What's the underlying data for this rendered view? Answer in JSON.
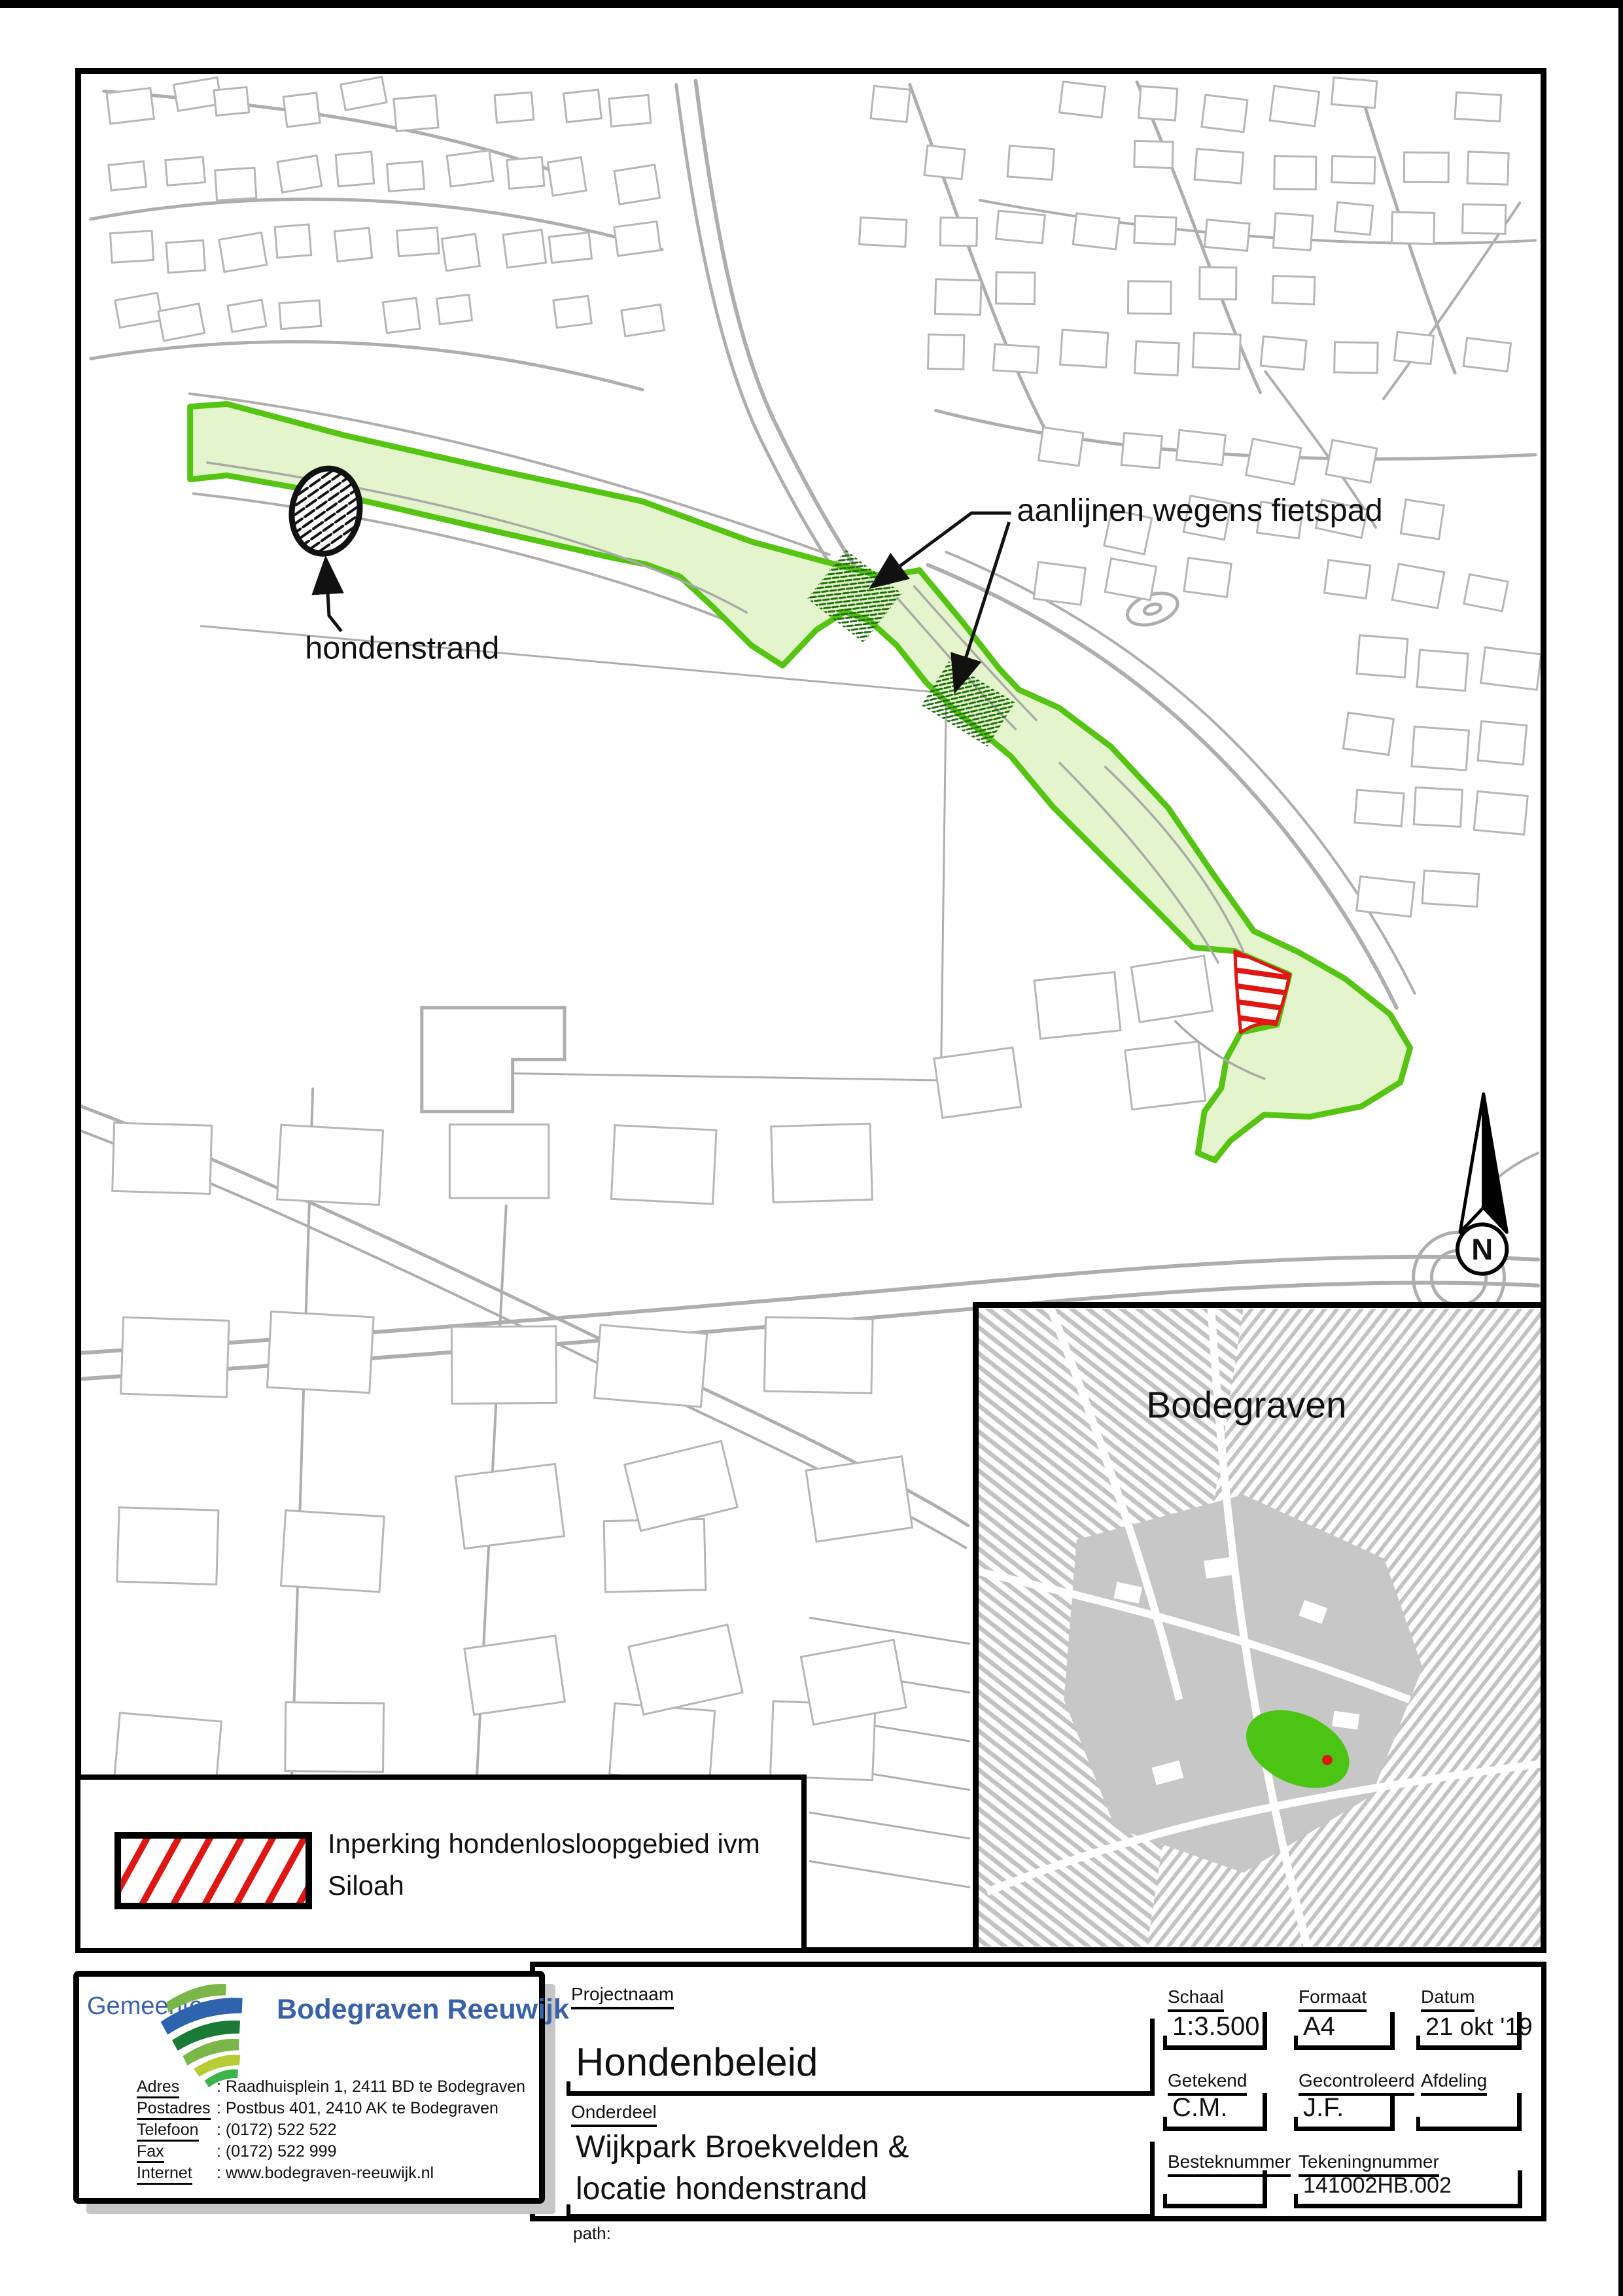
{
  "map": {
    "label_aanlijnen": "aanlijnen wegens fietspad",
    "label_hondenstrand": "hondenstrand",
    "north_label": "N"
  },
  "inset": {
    "title": "Bodegraven"
  },
  "legend": {
    "line1": "Inperking hondenlosloopgebied ivm",
    "line2": "Siloah"
  },
  "logo": {
    "gemeente": "Gemeente",
    "name": "Bodegraven Reeuwijk",
    "rows": [
      {
        "label": "Adres",
        "value": ": Raadhuisplein 1, 2411 BD te Bodegraven"
      },
      {
        "label": "Postadres",
        "value": ": Postbus 401, 2410 AK te Bodegraven"
      },
      {
        "label": "Telefoon",
        "value": ": (0172) 522 522"
      },
      {
        "label": "Fax",
        "value": ": (0172) 522 999"
      },
      {
        "label": "Internet",
        "value": ": www.bodegraven-reeuwijk.nl"
      }
    ]
  },
  "titleblock": {
    "projectnaam_label": "Projectnaam",
    "projectnaam_value": "Hondenbeleid",
    "onderdeel_label": "Onderdeel",
    "onderdeel_value_line1": "Wijkpark Broekvelden &",
    "onderdeel_value_line2": "locatie hondenstrand",
    "schaal_label": "Schaal",
    "schaal_value": "1:3.500",
    "formaat_label": "Formaat",
    "formaat_value": "A4",
    "datum_label": "Datum",
    "datum_value": "21 okt '19",
    "getekend_label": "Getekend",
    "getekend_value": "C.M.",
    "gecontroleerd_label": "Gecontroleerd",
    "gecontroleerd_value": "J.F.",
    "afdeling_label": "Afdeling",
    "afdeling_value": "",
    "besteknummer_label": "Besteknummer",
    "besteknummer_value": "",
    "tekeningnummer_label": "Tekeningnummer",
    "tekeningnummer_value": "141002HB.002",
    "path_label": "path:"
  },
  "colors": {
    "accent_green": "#55c413",
    "light_green": "#e4f5cd",
    "restriction_red": "#e01613",
    "map_gray": "#b6b6b6",
    "logo_blue": "#3a62a8"
  }
}
